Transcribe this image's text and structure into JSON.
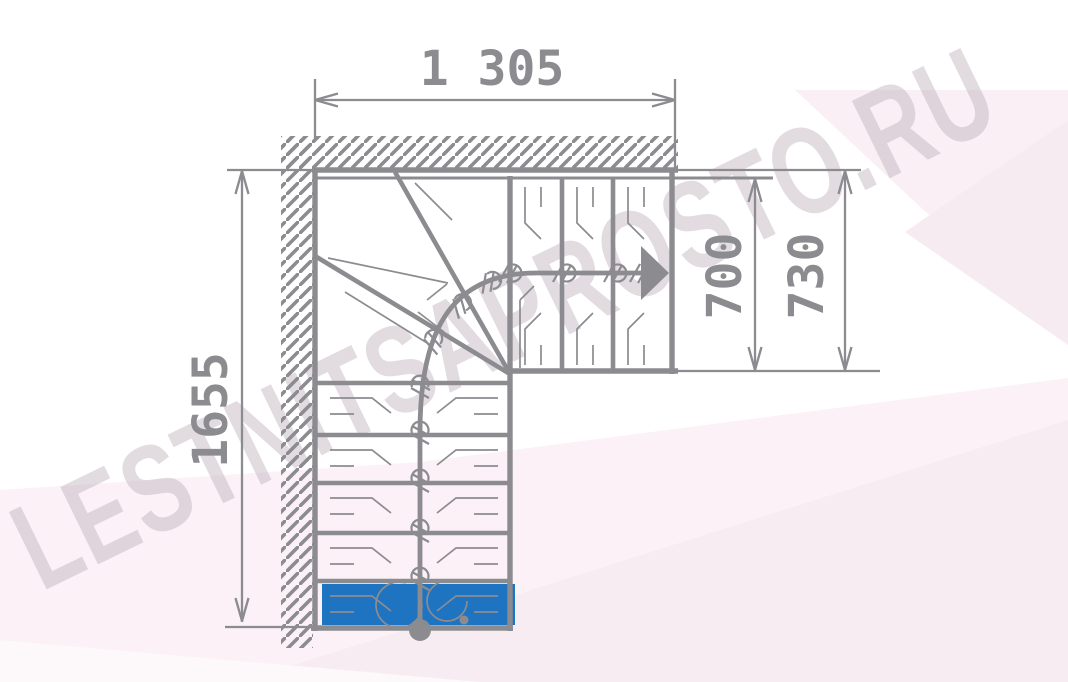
{
  "drawing": {
    "dimensions": {
      "top_width_mm": "1 305",
      "flight_width_inner_mm": "700",
      "flight_width_outer_mm": "730",
      "left_height_mm": "1655"
    },
    "watermark_text": "LESTNITSAPROSTO.RU",
    "colors": {
      "line_gray": "#8c8c90",
      "first_step_blue": "#1e74c0",
      "bg_pink_light": "#fbf1f7",
      "bg_pink_deep": "#f8ecf3",
      "watermark_text_color": "#ddd4da"
    }
  }
}
